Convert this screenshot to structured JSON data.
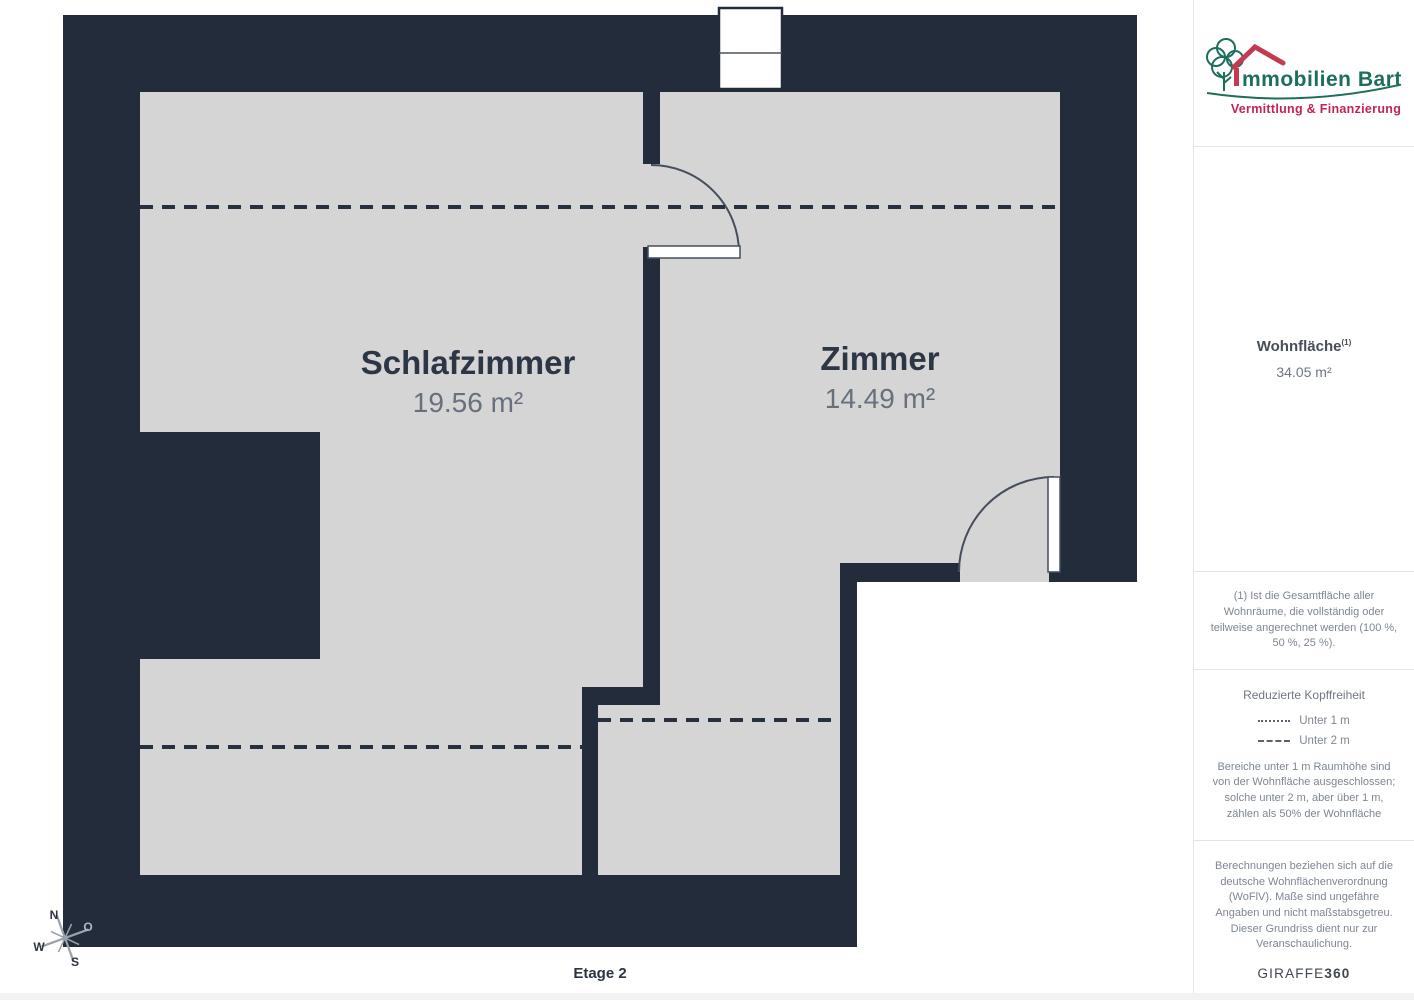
{
  "floorplan": {
    "rooms": [
      {
        "name": "Schlafzimmer",
        "area": "19.56 m²"
      },
      {
        "name": "Zimmer",
        "area": "14.49 m²"
      }
    ],
    "floor_label": "Etage 2",
    "compass": {
      "north": "N",
      "west": "W",
      "south": "S",
      "east": "O"
    }
  },
  "sidebar": {
    "logo": {
      "company_initial": "I",
      "company_rest": "mmobilien Bart",
      "tagline": "Vermittlung & Finanzierung"
    },
    "summary": {
      "title": "Wohnfläche",
      "marker": "(1)",
      "value": "34.05 m²"
    },
    "footnote": "(1) Ist die Gesamtfläche aller Wohnräume, die vollständig oder teilweise angerechnet werden (100 %, 50 %, 25 %).",
    "legend": {
      "title": "Reduzierte Kopffreiheit",
      "items": [
        {
          "style": "dotted",
          "label": "Unter 1 m"
        },
        {
          "style": "dashed",
          "label": "Unter 2 m"
        }
      ],
      "note": "Bereiche unter 1 m Raumhöhe sind von der Wohnfläche ausgeschlossen; solche unter 2 m, aber über 1 m, zählen als 50% der Wohnfläche"
    },
    "disclaimer": "Berechnungen beziehen sich auf die deutsche Wohnflächenverordnung (WoFlV). Maße sind ungefähre Angaben und nicht maßstabsgetreu. Dieser Grundriss dient nur zur Veranschaulichung.",
    "vendor": {
      "name": "GIRAFFE",
      "suffix": "360"
    }
  },
  "colors": {
    "wall": "#222c3a",
    "floor": "#d5d5d6",
    "logo_green": "#1d6e5c",
    "logo_red": "#c43a50",
    "tagline_red": "#c32355"
  }
}
